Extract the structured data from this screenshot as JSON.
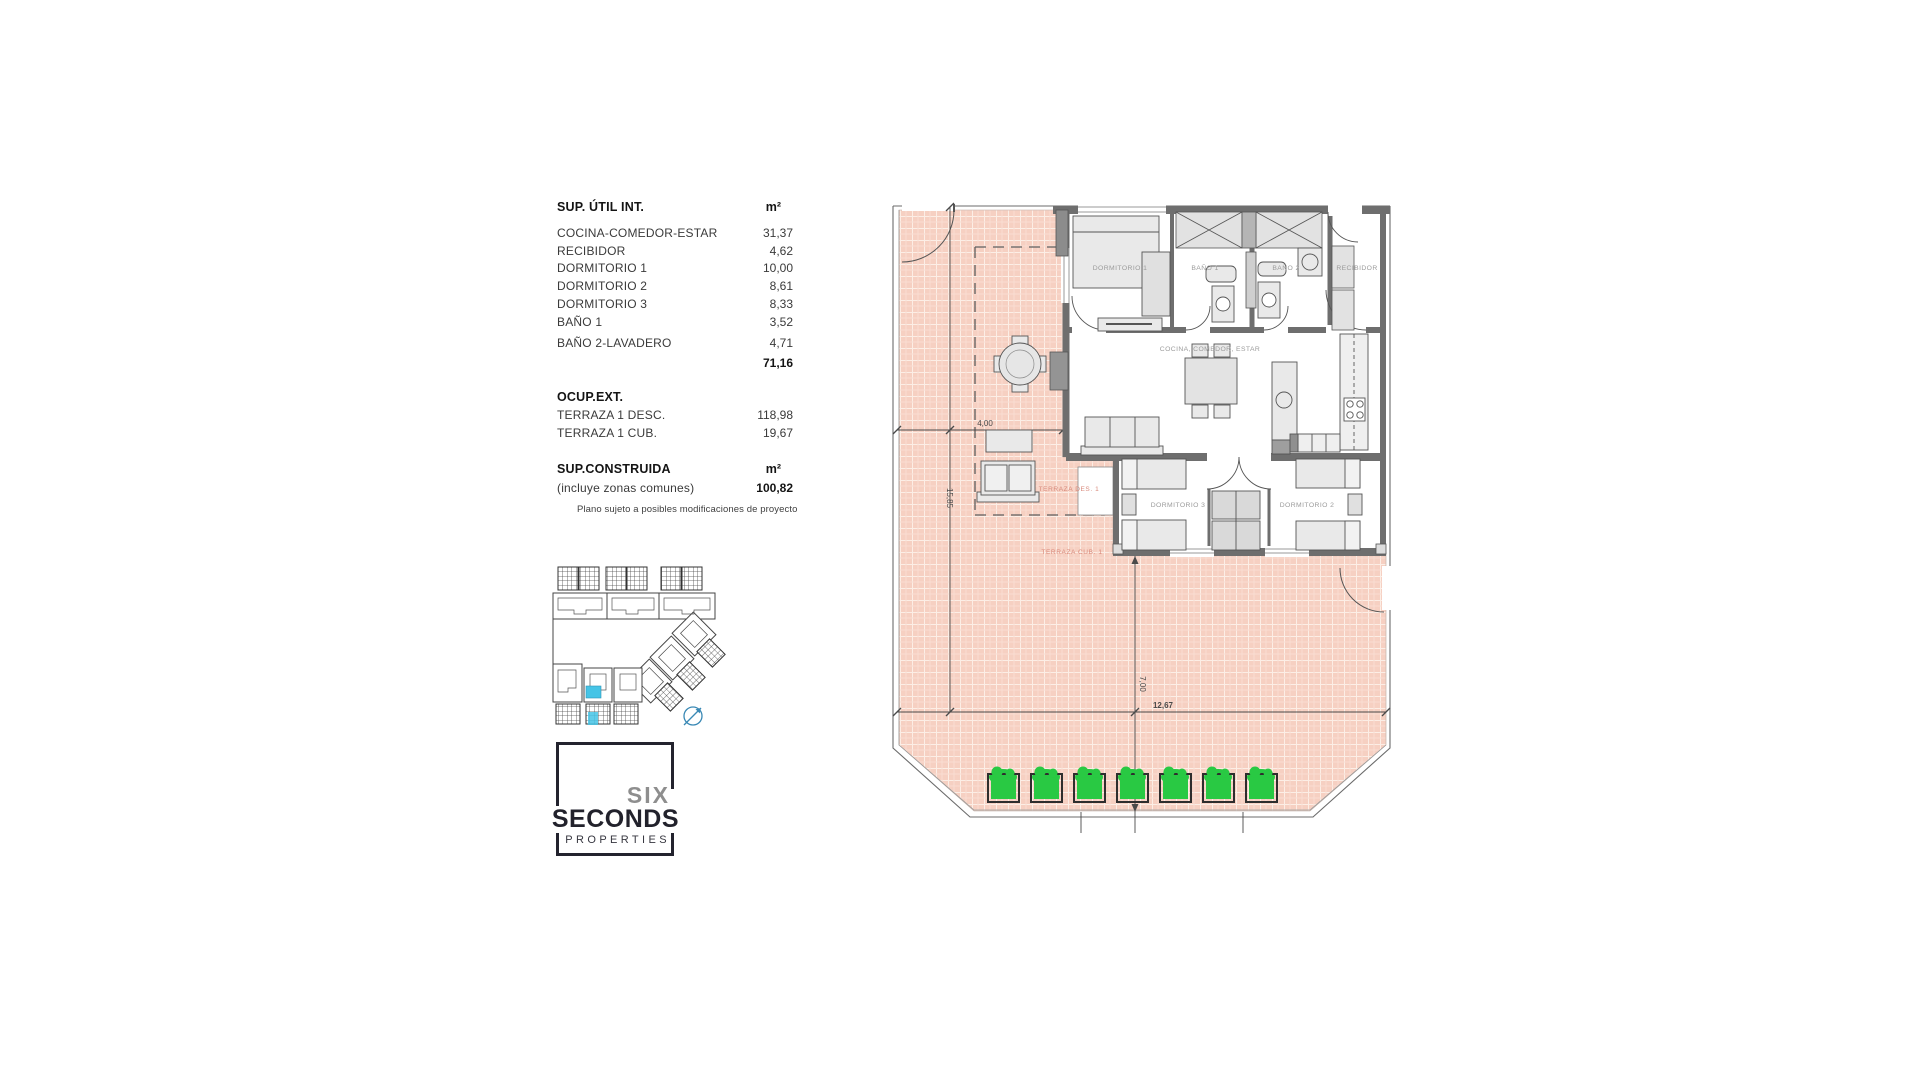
{
  "area_table": {
    "title": "SUP. ÚTIL INT.",
    "unit_header": "m²",
    "rows": [
      {
        "label": "COCINA-COMEDOR-ESTAR",
        "value": "31,37"
      },
      {
        "label": "RECIBIDOR",
        "value": "4,62"
      },
      {
        "label": "DORMITORIO 1",
        "value": "10,00"
      },
      {
        "label": "DORMITORIO 2",
        "value": "8,61"
      },
      {
        "label": "DORMITORIO 3",
        "value": "8,33"
      },
      {
        "label": "BAÑO 1",
        "value": "3,52"
      },
      {
        "label": "BAÑO 2-LAVADERO",
        "value": "4,71"
      }
    ],
    "total_value": "71,16",
    "ext": {
      "title": "OCUP.EXT.",
      "rows": [
        {
          "label": "TERRAZA 1 DESC.",
          "value": "118,98"
        },
        {
          "label": "TERRAZA 1 CUB.",
          "value": "19,67"
        }
      ]
    },
    "built": {
      "title": "SUP.CONSTRUIDA",
      "unit_header": "m²",
      "note": "(incluye zonas comunes)",
      "value": "100,82"
    },
    "disclaimer": "Plano sujeto a posibles modificaciones de proyecto"
  },
  "logo": {
    "word1": "SIX",
    "word2": "SECONDS",
    "word3": "PROPERTIES"
  },
  "floorplan": {
    "room_labels": {
      "dormitorio1": "DORMITORIO 1",
      "bano1": "BAÑO 1",
      "bano2": "BAÑO 2",
      "recibidor": "RECIBIDOR",
      "cocina": "COCINA, COMEDOR, ESTAR",
      "dormitorio3": "DORMITORIO 3",
      "dormitorio2": "DORMITORIO 2",
      "terraza_des": "TERRAZA DES. 1",
      "terraza_cub": "TERRAZA CUB. 1"
    },
    "dimensions": {
      "terrace_width": "4,00",
      "terrace_height": "15,85",
      "right_height": "7,00",
      "bottom_width": "12,67"
    },
    "colors": {
      "terrace_tile": "#f6d0c2",
      "wall_gray": "#6e6e6e",
      "planter_green": "#29c943",
      "highlight_cyan": "#45c4e6",
      "terrace_label": "#d8897b"
    }
  }
}
